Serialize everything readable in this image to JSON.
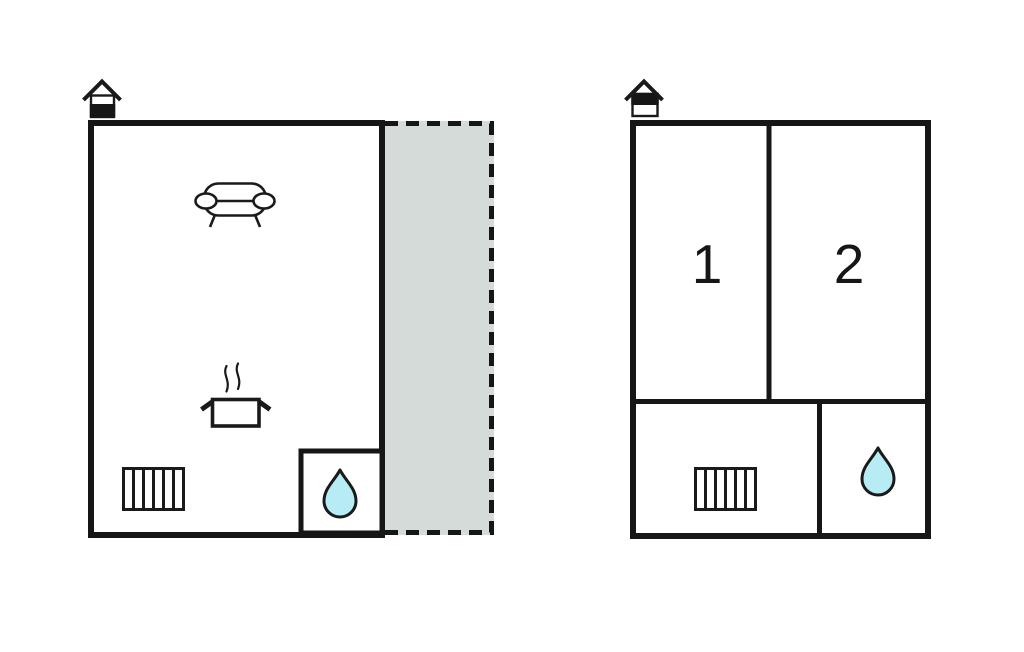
{
  "colors": {
    "wall": "#161616",
    "icon_line": "#1a1a1a",
    "room_fill": "#ffffff",
    "terrace_fill": "#d5dbd8",
    "water_drop_fill": "#b7ecf4",
    "room_label": "#161616"
  },
  "left_plan": {
    "feature_icons": [
      "house-entrance-icon",
      "sofa-icon",
      "cooking-pot-icon",
      "radiator-icon",
      "water-drop-icon"
    ],
    "terrace_outline_style": "dashed"
  },
  "right_plan": {
    "feature_icons": [
      "house-entrance-icon",
      "radiator-icon",
      "water-drop-icon"
    ],
    "rooms": [
      {
        "label": "1"
      },
      {
        "label": "2"
      }
    ]
  }
}
